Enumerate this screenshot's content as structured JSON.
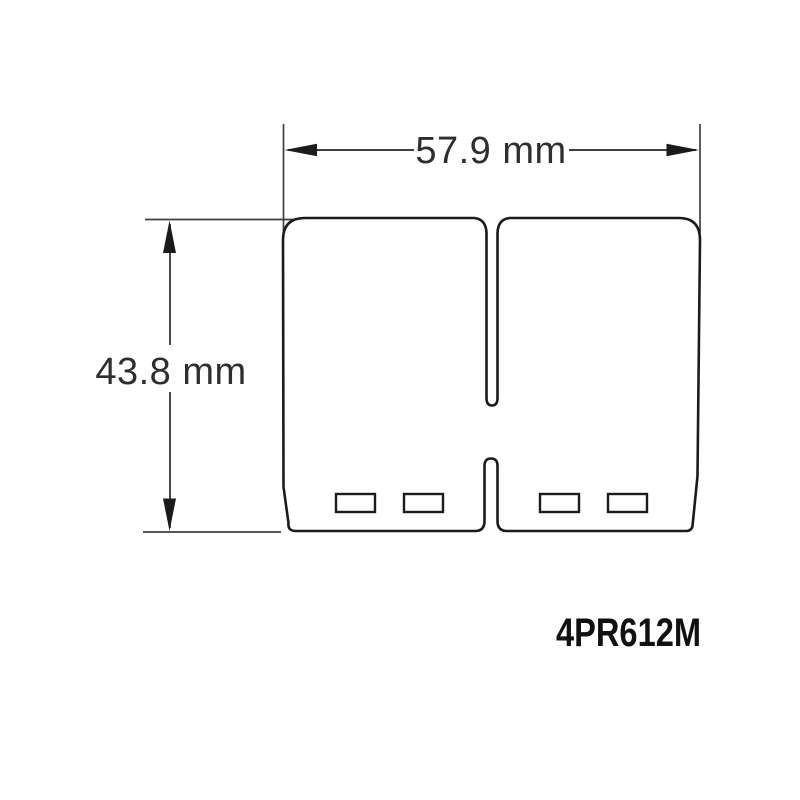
{
  "drawing": {
    "part_number": "4PR612M",
    "width_dimension": {
      "label": "57.9 mm"
    },
    "height_dimension": {
      "label": "43.8 mm"
    },
    "colors": {
      "background": "#ffffff",
      "outline": "#1b1b1b",
      "dimension_line": "#3f3f3f",
      "text": "#2e2e2e"
    }
  }
}
